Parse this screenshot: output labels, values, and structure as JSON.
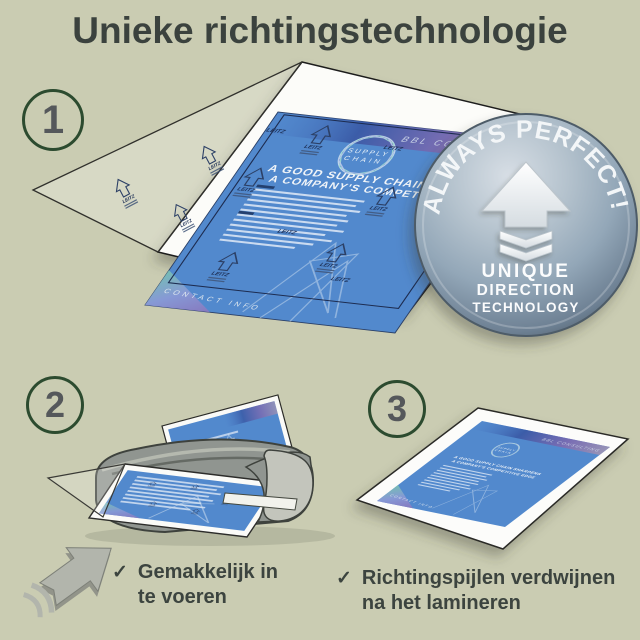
{
  "title": "Unieke richtingstechnologie",
  "steps": {
    "step1_number": "1",
    "step2_number": "2",
    "step3_number": "3"
  },
  "badge": {
    "arc_text": "ALWAYS PERFECT!",
    "label_line1": "UNIQUE",
    "label_line2": "DIRECTION",
    "label_line3": "TECHNOLOGY"
  },
  "flyer": {
    "brand": "BBL CONSULTING",
    "logo_word1": "SUPPLY",
    "logo_word2": "CHAIN",
    "headline_line1": "A GOOD SUPPLY CHAIN SHARPENS",
    "headline_line2": "A COMPANY'S COMPETITIVE EDGE",
    "footer_label": "CONTACT INFO"
  },
  "pouch": {
    "brand": "LEITZ"
  },
  "captions": {
    "step2": {
      "check": "✓",
      "line1": "Gemakkelijk in",
      "line2": "te voeren"
    },
    "step3": {
      "check": "✓",
      "line1": "Richtingspijlen verdwijnen",
      "line2": "na het lamineren"
    }
  },
  "colors": {
    "background": "#caccb2",
    "heading_text": "#3b423e",
    "flyer_blue": "#5289cd",
    "pouch_print_navy": "#1d2f55",
    "badge_metal": "#8ba1b4",
    "step_circle_border": "#2c4b2f",
    "machine_gray": "#909590"
  }
}
